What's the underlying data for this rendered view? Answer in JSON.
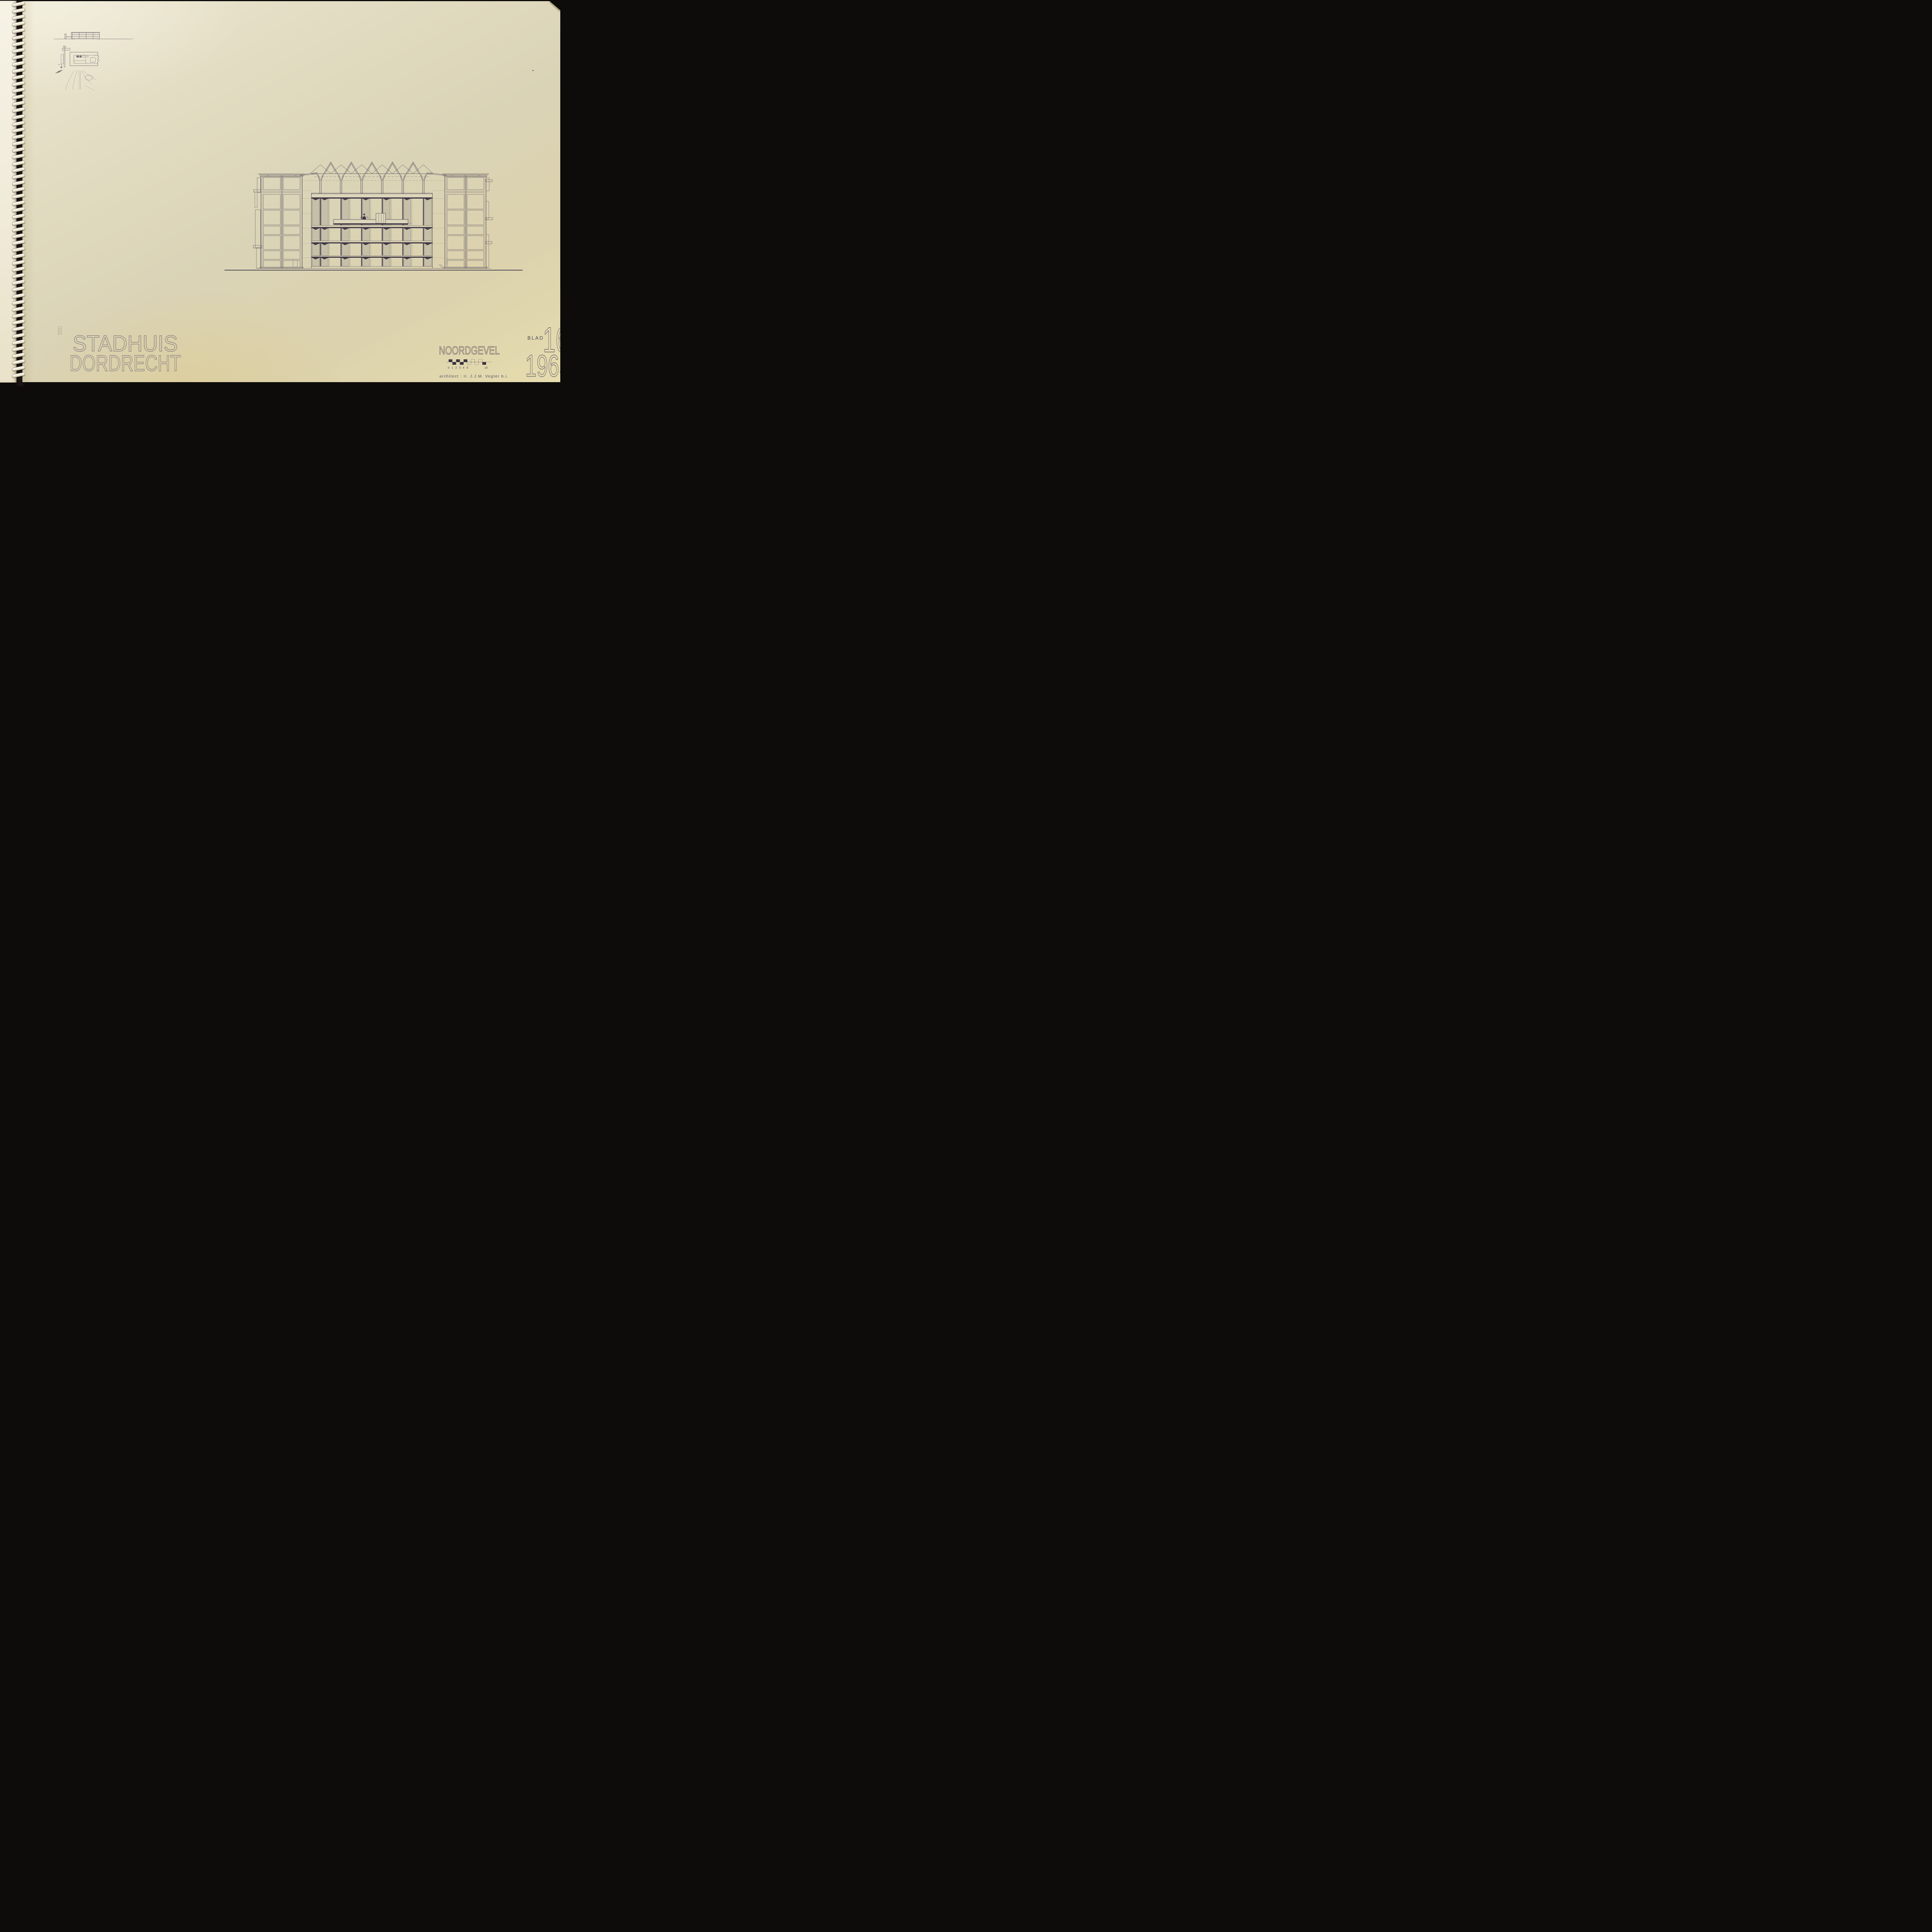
{
  "project": {
    "title_line1": "STADHUIS",
    "title_line2": "DORDRECHT"
  },
  "drawing": {
    "title": "NOORDGEVEL",
    "credit": "architect : Ir. J.J.M. Vegter  b.i."
  },
  "sheet": {
    "label": "BLAD",
    "number": "16",
    "year": "1965"
  },
  "scale_bar": {
    "tick_labels": [
      "0",
      "1",
      "2",
      "3",
      "4",
      "5",
      "10"
    ],
    "total_units": 10
  },
  "colors": {
    "background": "#0d0c0a",
    "paper": "#dad3b6",
    "paper_left_page": "#f0ebd9",
    "ink": "#4b4454",
    "ink_dark": "#3a3342",
    "outline_text": "#6e6878"
  }
}
